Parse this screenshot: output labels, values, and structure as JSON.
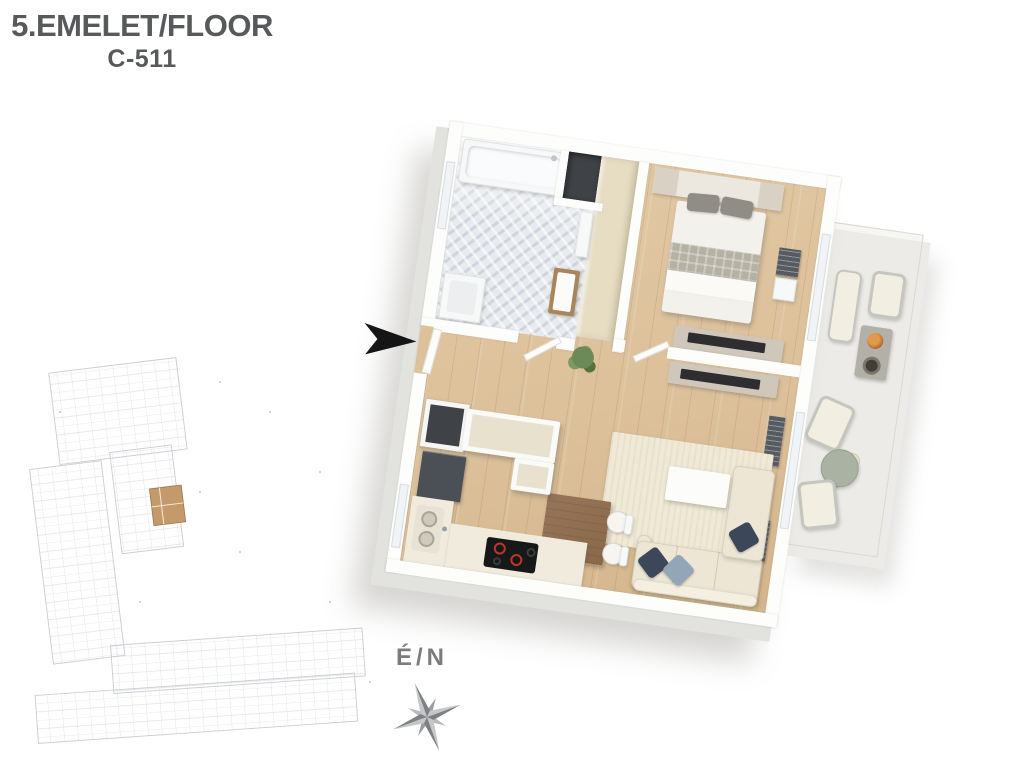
{
  "header": {
    "floor_label": "5.EMELET/FLOOR",
    "unit_label": "C-511"
  },
  "compass": {
    "label": "É/N"
  },
  "icons": {
    "entrance_arrow": "black right-pointing arrowhead marking apartment entrance",
    "compass_rose": "eight-point star compass rose, gray",
    "site_plan_highlight": "tan shaded unit showing apartment location in building"
  },
  "colors": {
    "title_text": "#58595b",
    "compass_text": "#7a7c7f",
    "wall": "#fdfdfc",
    "slab_shadow": "#e2e2df",
    "wood_floor": "#dcc19b",
    "tile_floor": "#e7eaee",
    "deck_floor": "#dcc7af",
    "wardrobe": "#e6ddc3",
    "shaft": "#3f4246",
    "cabinet_beige": "#e8e1cd",
    "appliance_dark": "#4b5057",
    "sofa_cream": "#ede6d5",
    "rug_cream": "#efe9d6",
    "pillow_navy": "#3c4759",
    "pillow_blue": "#93a6b7",
    "table_wood": "#8a6848",
    "sage_table": "#a9b2a3",
    "siteplan_line": "#c5c7cd",
    "siteplan_highlight": "#c49a6b",
    "arrow_black": "#151515"
  }
}
